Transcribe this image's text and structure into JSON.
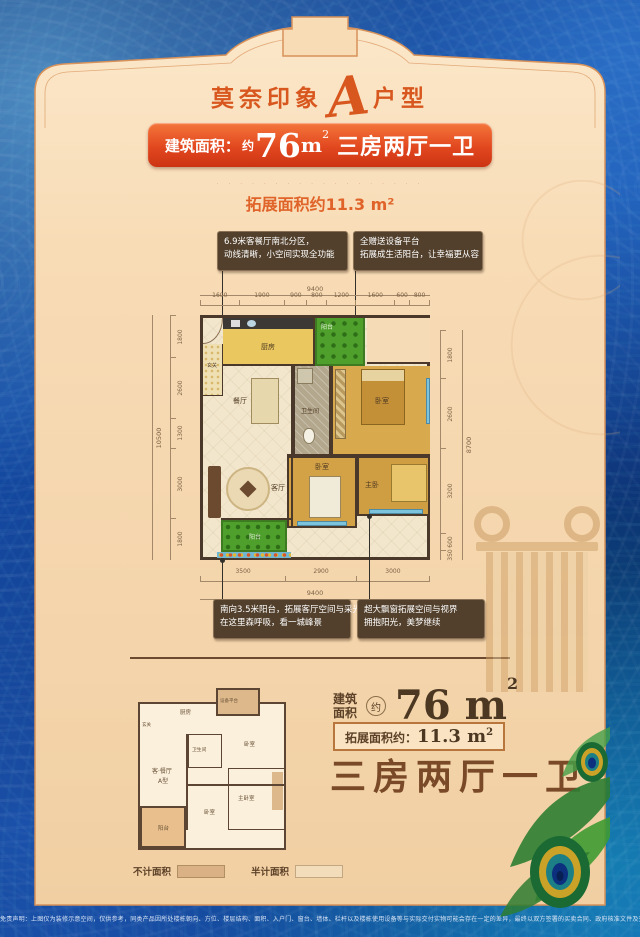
{
  "title": {
    "part1": "莫奈印象",
    "letter": "A",
    "part2": "户型"
  },
  "banner": {
    "label": "建筑面积：",
    "approx": "约",
    "value": "76",
    "unit": "m",
    "sup": "2",
    "rooms": "三房两厅一卫"
  },
  "faint_line": "· · · · · · · · · · · · · · · · · ·",
  "expand_line": "拓展面积约11.3 m²",
  "callouts_top": {
    "left": {
      "line1": "6.9米客餐厅南北分区，",
      "line2": "动线清晰，小空间实现全功能"
    },
    "right": {
      "line1": "全赠送设备平台",
      "line2": "拓展成生活阳台，让幸福更从容"
    }
  },
  "callouts_bottom": {
    "left": {
      "line1": "南向3.5米阳台，拓展客厅空间与采光",
      "line2": "在这里森呼吸，看一城峰景"
    },
    "right": {
      "line1": "超大飘窗拓展空间与视界",
      "line2": "拥抱阳光，美梦继续"
    }
  },
  "floor_plan": {
    "dims_top_total": "9400",
    "dims_top": [
      "1600",
      "1900",
      "900",
      "800",
      "1200",
      "1600",
      "600",
      "800"
    ],
    "dims_bottom": [
      "3500",
      "2900",
      "3000"
    ],
    "dims_bottom_total": "9400",
    "dims_left_total": "10500",
    "dims_left": [
      "1800",
      "2600",
      "1300",
      "3000",
      "1800"
    ],
    "dims_right_total": "8700",
    "dims_right": [
      "1800",
      "2600",
      "3200",
      "600",
      "350"
    ],
    "rooms": {
      "foyer": "玄关",
      "kitchen": "厨房",
      "dining": "餐厅",
      "balcony_top": "阳台",
      "bed_top": "卧室",
      "bath": "卫生间",
      "living": "客厅",
      "bed_mid": "卧室",
      "master": "主卧",
      "balcony_bottom": "阳台"
    }
  },
  "mini_plan": {
    "rooms": {
      "foyer": "玄关",
      "kitchen": "厨房",
      "equip": "设备平台",
      "bath": "卫生间",
      "bed1": "卧室",
      "master": "主卧室",
      "bed2": "卧室",
      "living_dining": "客·餐厅",
      "type": "A型",
      "balcony": "阳台"
    }
  },
  "legend": {
    "no_count": "不计面积",
    "half_count": "半计面积"
  },
  "summary": {
    "building_l1": "建筑",
    "building_l2": "面积",
    "approx": "约",
    "value": "76 m",
    "sup": "2",
    "expand_label": "拓展面积约：",
    "expand_value": "11.3 m",
    "expand_sup": "2",
    "rooms": "三房两厅一卫"
  },
  "footer": "免责声明：上图仅为装修示意空间，仅供参考，同类产品因所处楼栋朝向、方位、楼层结构、面积、入户门、窗台、墙体、栏杆以及楼栋使用设备等与实际交付实物可能会存在一定的差异，最终以双方签署的买卖合同、政府核准文件及交付楼栋的实物为准。",
  "colors": {
    "accent_orange": "#d8571e",
    "banner_red": "#e2481f",
    "panel_cream": "#f6dcb6",
    "background_blue": "#1248a2",
    "wall_brown": "#4a392b",
    "balcony_green": "#4f9f2d",
    "wood_floor": "#d9a94d",
    "callout_brown": "#52402c",
    "text_brown": "#5c4128"
  }
}
